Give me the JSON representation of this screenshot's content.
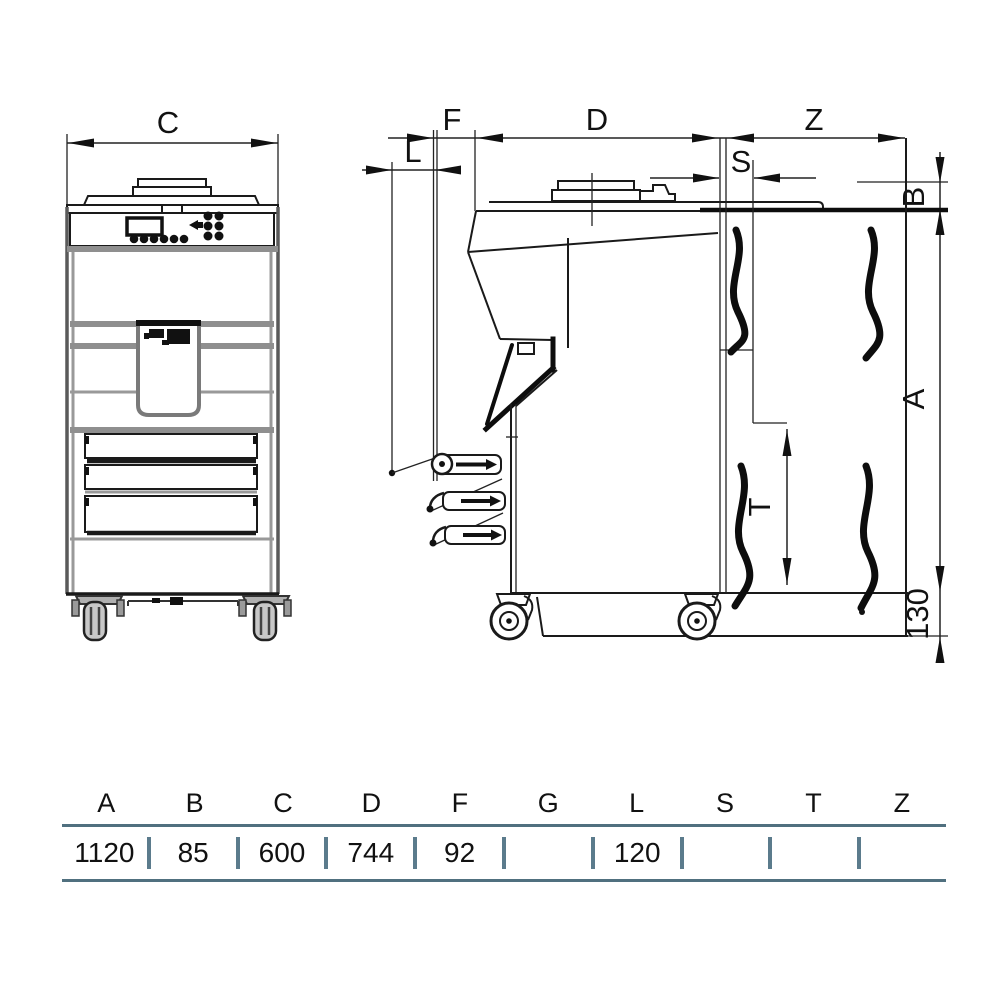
{
  "drawing": {
    "description": "Two-view technical dimension drawing of a floor-standing machine on casters",
    "dim_labels": {
      "c": "C",
      "f": "F",
      "d": "D",
      "z": "Z",
      "l": "L",
      "s": "S",
      "b": "B",
      "a": "A",
      "t": "T",
      "caster_height": "130"
    }
  },
  "table": {
    "headers": [
      "A",
      "B",
      "C",
      "D",
      "F",
      "G",
      "L",
      "S",
      "T",
      "Z"
    ],
    "values": [
      "1120",
      "85",
      "600",
      "744",
      "92",
      "",
      "120",
      "",
      "",
      ""
    ]
  },
  "colors": {
    "line": "#1a1a1a",
    "gray_fill": "#8f8f8f",
    "table_rule": "#50707f"
  }
}
